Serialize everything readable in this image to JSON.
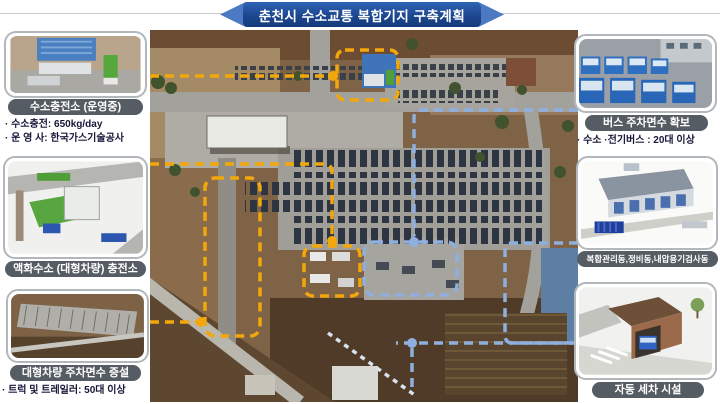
{
  "title": "춘천시 수소교통 복합기지 구축계획",
  "left_panels": [
    {
      "caption": "수소충전소 (운영중)",
      "bullets": [
        "· 수소충전: 650kg/day",
        "· 운 영 사: 한국가스기술공사"
      ]
    },
    {
      "caption": "액화수소 (대형차량) 충전소",
      "bullets": []
    },
    {
      "caption": "대형차량 주차면수 증설",
      "bullets": [
        "· 트럭 및 트레일러: 50대 이상"
      ]
    }
  ],
  "right_panels": [
    {
      "caption": "버스 주차면수 확보",
      "bullets": [
        "· 수소 ·전기버스 : 20대 이상"
      ]
    },
    {
      "caption": "복합관리동,정비동,내압용기검사동",
      "bullets": []
    },
    {
      "caption": "자동 세차 시설",
      "bullets": []
    }
  ],
  "colors": {
    "banner_dark": "#1c478f",
    "banner_light": "#4b79c4",
    "caption_pill": "#565c63",
    "bullet_text": "#17173a",
    "yellow_dash": "#f2a70b",
    "blue_dash": "#8fb0de",
    "card_border": "#b2b7bc"
  }
}
